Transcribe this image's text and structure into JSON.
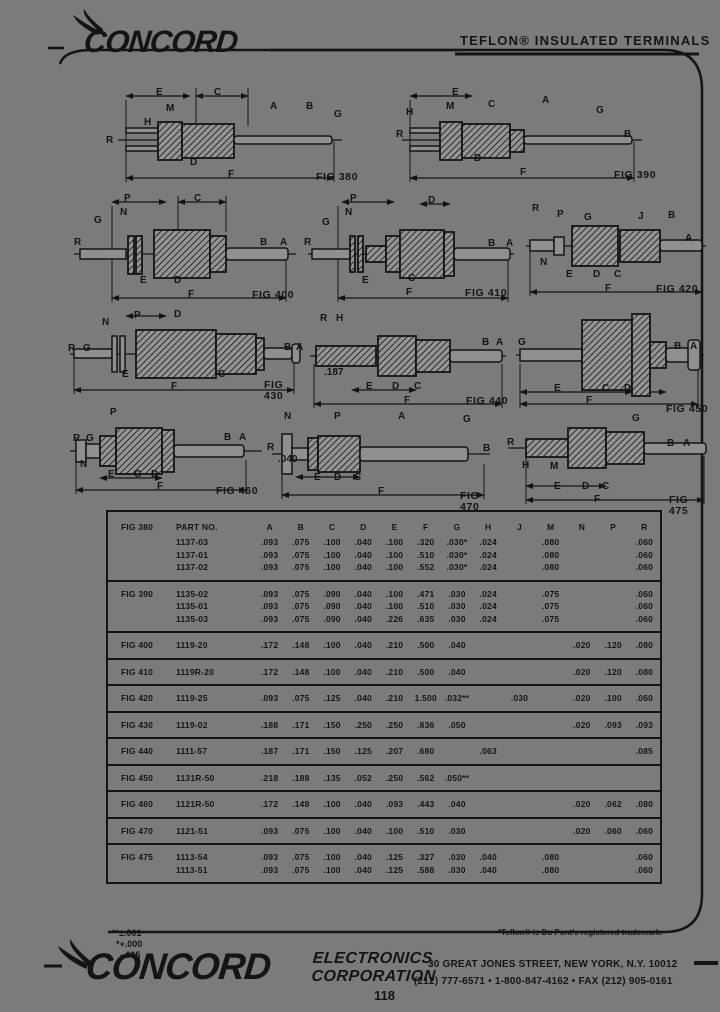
{
  "page": {
    "bg_color": "#7b7b7b",
    "ink_color": "#141414",
    "page_number": "118"
  },
  "header": {
    "brand": "CONCORD",
    "title": "TEFLON® INSULATED TERMINALS"
  },
  "figures": [
    {
      "id": "fig380",
      "caption": "FIG 380",
      "labels": [
        "E",
        "M",
        "C",
        "A",
        "B",
        "G",
        "H",
        "R",
        "D",
        "F"
      ]
    },
    {
      "id": "fig390",
      "caption": "FIG 390",
      "labels": [
        "H",
        "M",
        "E",
        "C",
        "A",
        "G",
        "R",
        "B",
        "D",
        "F"
      ]
    },
    {
      "id": "fig400",
      "caption": "FIG 400",
      "labels": [
        "P",
        "N",
        "C",
        "G",
        "R",
        "B",
        "A",
        "E",
        "D",
        "F"
      ]
    },
    {
      "id": "fig410",
      "caption": "FIG 410",
      "labels": [
        "P",
        "N",
        "D",
        "G",
        "R",
        "B",
        "A",
        "E",
        "C",
        "F"
      ]
    },
    {
      "id": "fig420",
      "caption": "FIG 420",
      "labels": [
        "R",
        "P",
        "G",
        "J",
        "B",
        "A",
        "N",
        "E",
        "D",
        "C",
        "F"
      ]
    },
    {
      "id": "fig430",
      "caption": "FIG 430",
      "labels": [
        "N",
        "P",
        "D",
        "R",
        "G",
        "B",
        "A",
        "E",
        "C",
        "F"
      ]
    },
    {
      "id": "fig440",
      "caption": "FIG 440",
      "labels": [
        "R",
        "H",
        "B",
        "A",
        ".187",
        "E",
        "D",
        "C",
        "F"
      ]
    },
    {
      "id": "fig450",
      "caption": "FIG 450",
      "labels": [
        "G",
        "B",
        "A",
        "E",
        "C",
        "D",
        "F"
      ]
    },
    {
      "id": "fig460",
      "caption": "FIG 460",
      "labels": [
        "P",
        "R",
        "G",
        "B",
        "A",
        "N",
        "E",
        "C",
        "D",
        "F"
      ]
    },
    {
      "id": "fig470",
      "caption": "FIG 470",
      "labels": [
        "N",
        "P",
        "A",
        "G",
        "R",
        ".040",
        "B",
        "E",
        "D",
        "C",
        "F"
      ]
    },
    {
      "id": "fig475",
      "caption": "FIG 475",
      "labels": [
        "R",
        "G",
        "B",
        "A",
        "H",
        "M",
        "E",
        "D",
        "C",
        "F"
      ]
    }
  ],
  "table": {
    "part_no_header": "PART NO.",
    "columns": [
      "A",
      "B",
      "C",
      "D",
      "E",
      "F",
      "G",
      "H",
      "J",
      "M",
      "N",
      "P",
      "R"
    ],
    "groups": [
      {
        "fig": "FIG 380",
        "rows": [
          {
            "part": "1137-03",
            "values": [
              ".093",
              ".075",
              ".100",
              ".040",
              ".100",
              ".320",
              ".030*",
              ".024",
              "",
              ".080",
              "",
              "",
              ".060"
            ]
          },
          {
            "part": "1137-01",
            "values": [
              ".093",
              ".075",
              ".100",
              ".040",
              ".100",
              ".510",
              ".030*",
              ".024",
              "",
              ".080",
              "",
              "",
              ".060"
            ]
          },
          {
            "part": "1137-02",
            "values": [
              ".093",
              ".075",
              ".100",
              ".040",
              ".100",
              ".552",
              ".030*",
              ".024",
              "",
              ".080",
              "",
              "",
              ".060"
            ]
          }
        ]
      },
      {
        "fig": "FIG 390",
        "rows": [
          {
            "part": "1135-02",
            "values": [
              ".093",
              ".075",
              ".090",
              ".040",
              ".100",
              ".471",
              ".030",
              ".024",
              "",
              ".075",
              "",
              "",
              ".060"
            ]
          },
          {
            "part": "1135-01",
            "values": [
              ".093",
              ".075",
              ".090",
              ".040",
              ".100",
              ".510",
              ".030",
              ".024",
              "",
              ".075",
              "",
              "",
              ".060"
            ]
          },
          {
            "part": "1135-03",
            "values": [
              ".093",
              ".075",
              ".090",
              ".040",
              ".226",
              ".635",
              ".030",
              ".024",
              "",
              ".075",
              "",
              "",
              ".060"
            ]
          }
        ]
      },
      {
        "fig": "FIG 400",
        "rows": [
          {
            "part": "1119-20",
            "values": [
              ".172",
              ".148",
              ".100",
              ".040",
              ".210",
              ".500",
              ".040",
              "",
              "",
              "",
              ".020",
              ".120",
              ".080"
            ]
          }
        ]
      },
      {
        "fig": "FIG 410",
        "rows": [
          {
            "part": "1119R-20",
            "values": [
              ".172",
              ".148",
              ".100",
              ".040",
              ".210",
              ".500",
              ".040",
              "",
              "",
              "",
              ".020",
              ".120",
              ".080"
            ]
          }
        ]
      },
      {
        "fig": "FIG 420",
        "rows": [
          {
            "part": "1119-25",
            "values": [
              ".093",
              ".075",
              ".125",
              ".040",
              ".210",
              "1.500",
              ".032**",
              "",
              ".030",
              "",
              ".020",
              ".100",
              ".060"
            ]
          }
        ]
      },
      {
        "fig": "FIG 430",
        "rows": [
          {
            "part": "1119-02",
            "values": [
              ".188",
              ".171",
              ".150",
              ".250",
              ".250",
              ".836",
              ".050",
              "",
              "",
              "",
              ".020",
              ".093",
              ".093"
            ]
          }
        ]
      },
      {
        "fig": "FIG 440",
        "rows": [
          {
            "part": "1111-57",
            "values": [
              ".187",
              ".171",
              ".150",
              ".125",
              ".207",
              ".680",
              "",
              ".063",
              "",
              "",
              "",
              "",
              ".085"
            ]
          }
        ]
      },
      {
        "fig": "FIG 450",
        "rows": [
          {
            "part": "1131R-50",
            "values": [
              ".218",
              ".188",
              ".135",
              ".052",
              ".250",
              ".562",
              ".050**",
              "",
              "",
              "",
              "",
              "",
              ""
            ]
          }
        ]
      },
      {
        "fig": "FIG 460",
        "rows": [
          {
            "part": "1121R-50",
            "values": [
              ".172",
              ".148",
              ".100",
              ".040",
              ".093",
              ".443",
              ".040",
              "",
              "",
              "",
              ".020",
              ".062",
              ".080"
            ]
          }
        ]
      },
      {
        "fig": "FIG 470",
        "rows": [
          {
            "part": "1121-51",
            "values": [
              ".093",
              ".075",
              ".100",
              ".040",
              ".100",
              ".510",
              ".030",
              "",
              "",
              "",
              ".020",
              ".060",
              ".060"
            ]
          }
        ]
      },
      {
        "fig": "FIG 475",
        "rows": [
          {
            "part": "1113-54",
            "values": [
              ".093",
              ".075",
              ".100",
              ".040",
              ".125",
              ".327",
              ".030",
              ".040",
              "",
              ".080",
              "",
              "",
              ".060"
            ]
          },
          {
            "part": "1113-51",
            "values": [
              ".093",
              ".075",
              ".100",
              ".040",
              ".125",
              ".588",
              ".030",
              ".040",
              "",
              ".080",
              "",
              "",
              ".060"
            ]
          }
        ]
      }
    ]
  },
  "footnotes": {
    "left": [
      "**±.001",
      "*+.000",
      "-.005"
    ],
    "right": "*Teflon® is Du Pont's registered trademark."
  },
  "footer": {
    "brand": "CONCORD",
    "division_line1": "ELECTRONICS",
    "division_line2": "CORPORATION",
    "address": "30 GREAT JONES STREET, NEW YORK, N.Y. 10012",
    "phones": "(212) 777-6571  •  1-800-847-4162  •  FAX (212) 905-0161"
  }
}
